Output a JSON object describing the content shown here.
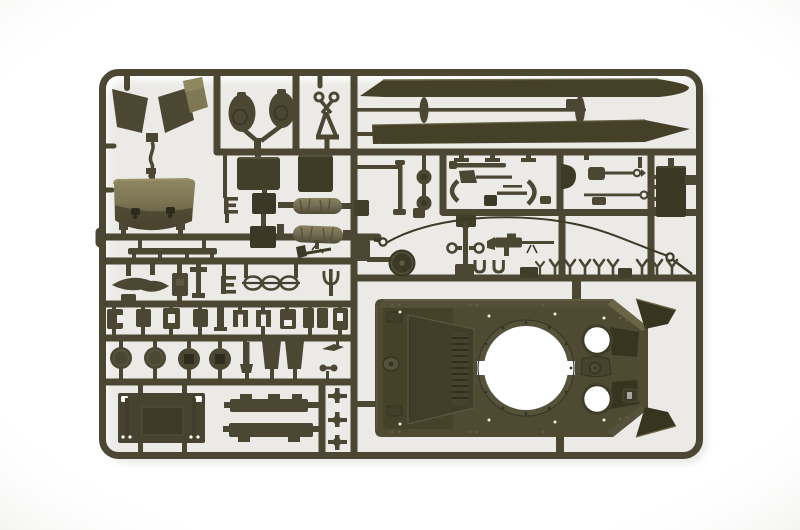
{
  "scene": {
    "description": "Top-down studio photograph of an olive drab injection-molded polystyrene model kit sprue (runner) holding tank model parts, on a seamless white background",
    "subject": "armor model kit sprue: upper hull with turret ring opening, sand shields, front fender scoop, crew hatches, road wheels, engine deck plate, pioneer tools, tow cable and small fittings",
    "material": "olive drab styrene plastic",
    "background": "white seamless backdrop with soft vignette"
  },
  "palette": {
    "background": "#ffffff",
    "vignette": "#e9e8e4",
    "shadow": "#dcdad3",
    "sprue": "#4b4733",
    "sprue_dark": "#3d3a27",
    "sprue_darker": "#2e2b1c",
    "sprue_light": "#5d5940",
    "highlight": "#938b63",
    "scoop_top": "#8f8762",
    "scoop_mid": "#7c7554",
    "scoop_bottom": "#514c35",
    "cylinder_top": "#8a8260",
    "cylinder_bottom": "#514c36",
    "hull": "#4f4b33",
    "hull_panel": "#403d29",
    "hull_shadow": "#37341f",
    "opening": "#ffffff",
    "cable": "#3c3927"
  },
  "parts": [
    {
      "id": "sprue-frame",
      "label": "rectangular runner frame with internal rails"
    },
    {
      "id": "mudguard-panels",
      "label": "angled mudguard / fender panels (3)"
    },
    {
      "id": "hatch-discs",
      "label": "round hatch lids (2)"
    },
    {
      "id": "clevis-pliers-part",
      "label": "towing clevis / scissor-shaped fitting"
    },
    {
      "id": "sand-shield-upper",
      "label": "long tapered sand shield strip"
    },
    {
      "id": "sand-shield-lower",
      "label": "long tapered sand shield strip, mirrored"
    },
    {
      "id": "tow-rod",
      "label": "thin rod with mounting bosses"
    },
    {
      "id": "front-scoop-fender",
      "label": "curved front fender scoop with glossy top"
    },
    {
      "id": "tread-bar",
      "label": "flat tread strip"
    },
    {
      "id": "stowage-panels",
      "label": "flat stowage panels (2)"
    },
    {
      "id": "e-bracket",
      "label": "small E-shaped bracket"
    },
    {
      "id": "stowage-blocks",
      "label": "dark stowage blocks (2)"
    },
    {
      "id": "log-cylinders",
      "label": "textured cylindrical stowage rolls (2)"
    },
    {
      "id": "axe-part",
      "label": "small axe with handle"
    },
    {
      "id": "periscope-rod",
      "label": "thin periscope rod and link"
    },
    {
      "id": "twin-discs",
      "label": "two small discs on a stem"
    },
    {
      "id": "tool-cluster",
      "label": "pioneer tools: bar, axe, pry bar, crescent brackets, shovel"
    },
    {
      "id": "rod-with-ring-1",
      "label": "cleaning rod with eyelet"
    },
    {
      "id": "rod-with-ring-2",
      "label": "cleaning rod with eyelet"
    },
    {
      "id": "stowage-box-large",
      "label": "large dark stowage box"
    },
    {
      "id": "tow-cable",
      "label": "thin tow cable with eyelets at both ends"
    },
    {
      "id": "idler-wheel",
      "label": "solid idler wheel"
    },
    {
      "id": "ring-post",
      "label": "post with two eye rings"
    },
    {
      "id": "machine-gun",
      "label": "machine gun with barrel"
    },
    {
      "id": "u-clips",
      "label": "U-shaped clips (2)"
    },
    {
      "id": "footman-loops",
      "label": "row of small Y-shaped footman loops (9)"
    },
    {
      "id": "lens-fairing",
      "label": "lens-shaped fairing pair"
    },
    {
      "id": "hinge-row",
      "label": "row of small hinges and brackets"
    },
    {
      "id": "road-wheels",
      "label": "road wheels (2 plain, 2 with square hubs)"
    },
    {
      "id": "mud-flaps",
      "label": "trapezoid mud flaps (2)"
    },
    {
      "id": "engine-deck-plate",
      "label": "rectangular engine deck plate with corner holes"
    },
    {
      "id": "side-rails",
      "label": "notched side rails (2)"
    },
    {
      "id": "lifting-pins",
      "label": "cross-shaped lifting pins (3)"
    },
    {
      "id": "hull-upper",
      "label": "upper hull: turret ring opening, two crew hatch openings, driver vision panel, beveled glacis wings"
    }
  ]
}
